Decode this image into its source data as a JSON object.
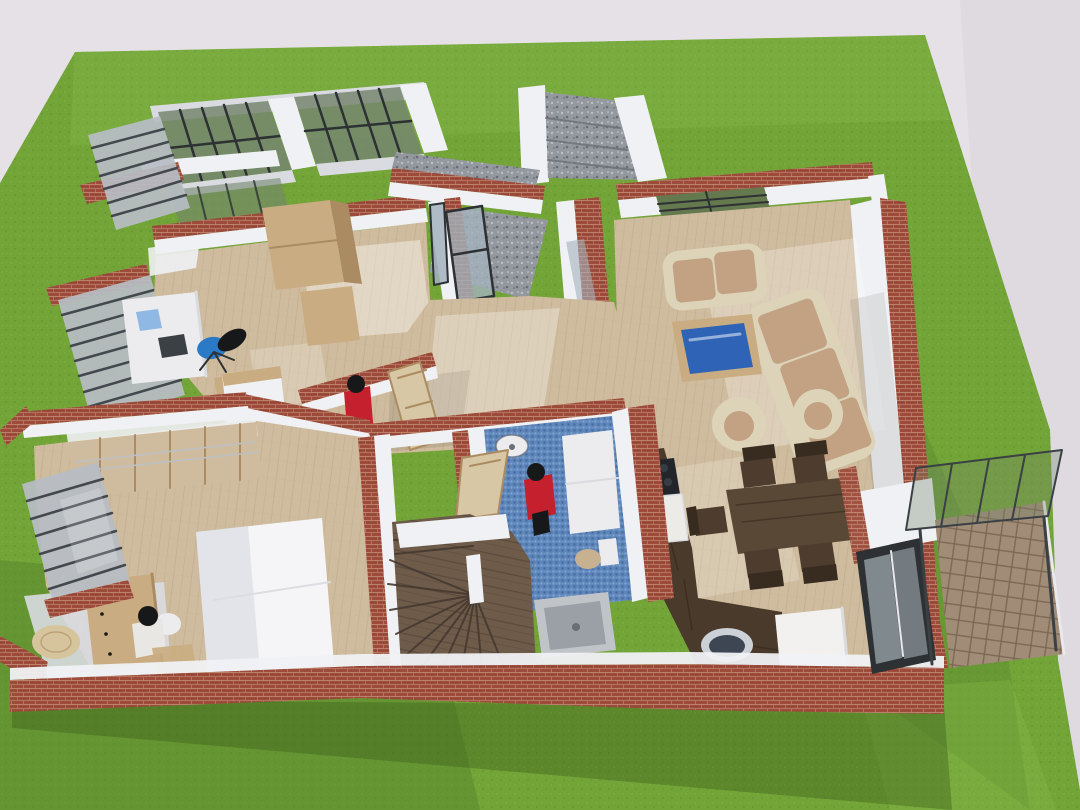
{
  "scene": {
    "alt": "3D dollhouse cutaway render of a single-storey house floor plan seen from above, set on a green grass lot: office with desk and blue chair, entry hall with glass door and granite steps, living room with cream sofas and blue glass coffee table, dining table with six chairs, kitchen strip with cooktop and fridge, blue-tiled bathroom with shower and toilet, winder staircase, bedroom with bed, desk and louvered windows, and a paved terrace with glass canopy"
  },
  "colors": {
    "sky": "#e6e1e7",
    "sky_shade": "#d9d5db",
    "grass": "#72a437",
    "grass_light": "#8cbd4e",
    "grass_dark": "#517f2a",
    "grass_shadow": "#365417",
    "brick": "#9d4b3b",
    "brick_light": "#c58d77",
    "brick_dark": "#7c3429",
    "wall": "#f0f1f4",
    "wall_shade": "#d9dbe1",
    "wood_floor": "#cfbc9e",
    "wood_line": "#b9a383",
    "wood_furn": "#c9ac81",
    "wood_furn_dark": "#ab8c62",
    "wood_door": "#d8c7a4",
    "table_wood": "#5a4836",
    "chair_wood": "#4e3d2e",
    "chair_wood_dark": "#382c21",
    "kitchen_floor": "#4a3a2b",
    "kitchen_line": "#352a1e",
    "stair": "#6e5b49",
    "stair_line": "#453931",
    "granite": "#94989f",
    "granite_light": "#bcc0c6",
    "granite_dark": "#696e76",
    "mosaic": "#5e86ba",
    "mosaic_light": "#82a5d1",
    "mosaic_dark": "#45689d",
    "paver": "#a18c77",
    "paver_line": "#77644f",
    "canopy_glass": "#75866e",
    "louver_window": "#65794f",
    "glass": "#a3b2bc",
    "glass_table": "#2e63b6",
    "frame": "#2d3134",
    "louver": "#b7bdc4",
    "slat": "#43484e",
    "sofa": "#ddd3b8",
    "cushion": "#c2a283",
    "fixture": "#ececee",
    "shower": "#c0c4c8",
    "shower_inner": "#9aa0a6",
    "toilet_seat": "#c7b191",
    "person_red": "#c5202e",
    "person_dark": "#17181a",
    "shirt": "#e9e7e3",
    "chair_blue": "#2b7ac6",
    "laptop": "#8fb8e4",
    "bed": "#f5f5f7",
    "bed_shade": "#dcdde2",
    "round_table": "#d5c49c",
    "fridge": "#f2f1ef",
    "cooktop": "#22252a",
    "burner": "#383d44",
    "counter": "#ecebe7",
    "basin": "#3e4653",
    "basin_rim": "#ccd1d7",
    "steel": "#3b4045",
    "white_trim": "#e9e9ed",
    "pane": "#858e93"
  }
}
